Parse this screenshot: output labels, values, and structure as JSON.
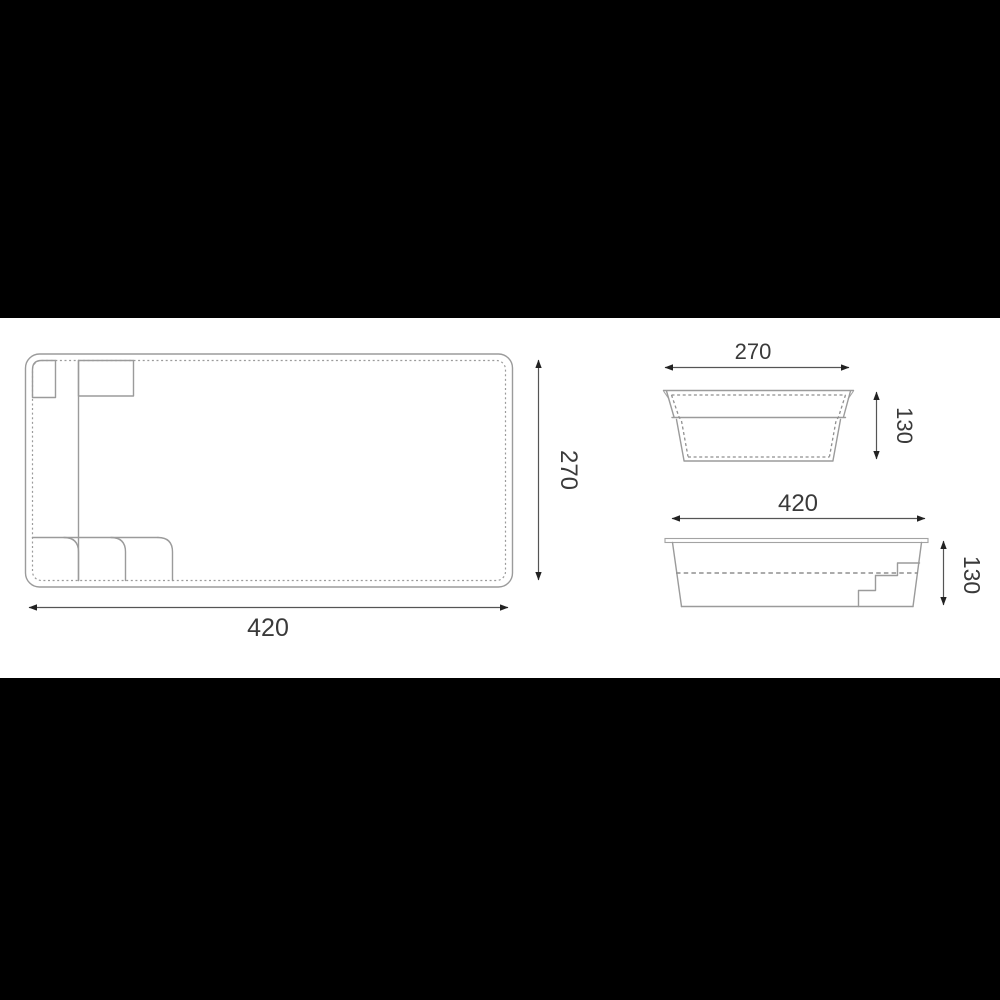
{
  "drawing": {
    "kind": "pool-dimension-drawing",
    "background_color": "#000000",
    "paper_color": "#ffffff",
    "line_color": "#9b9b9b",
    "dimension_color": "#555555",
    "text_color": "#3a3a3a"
  },
  "views": {
    "plan": {
      "name": "plan-view",
      "width_label": "420",
      "height_label": "270"
    },
    "end_section": {
      "name": "end-cross-section",
      "width_label": "270",
      "depth_label": "130"
    },
    "side_section": {
      "name": "side-cross-section",
      "length_label": "420",
      "depth_label": "130"
    }
  }
}
